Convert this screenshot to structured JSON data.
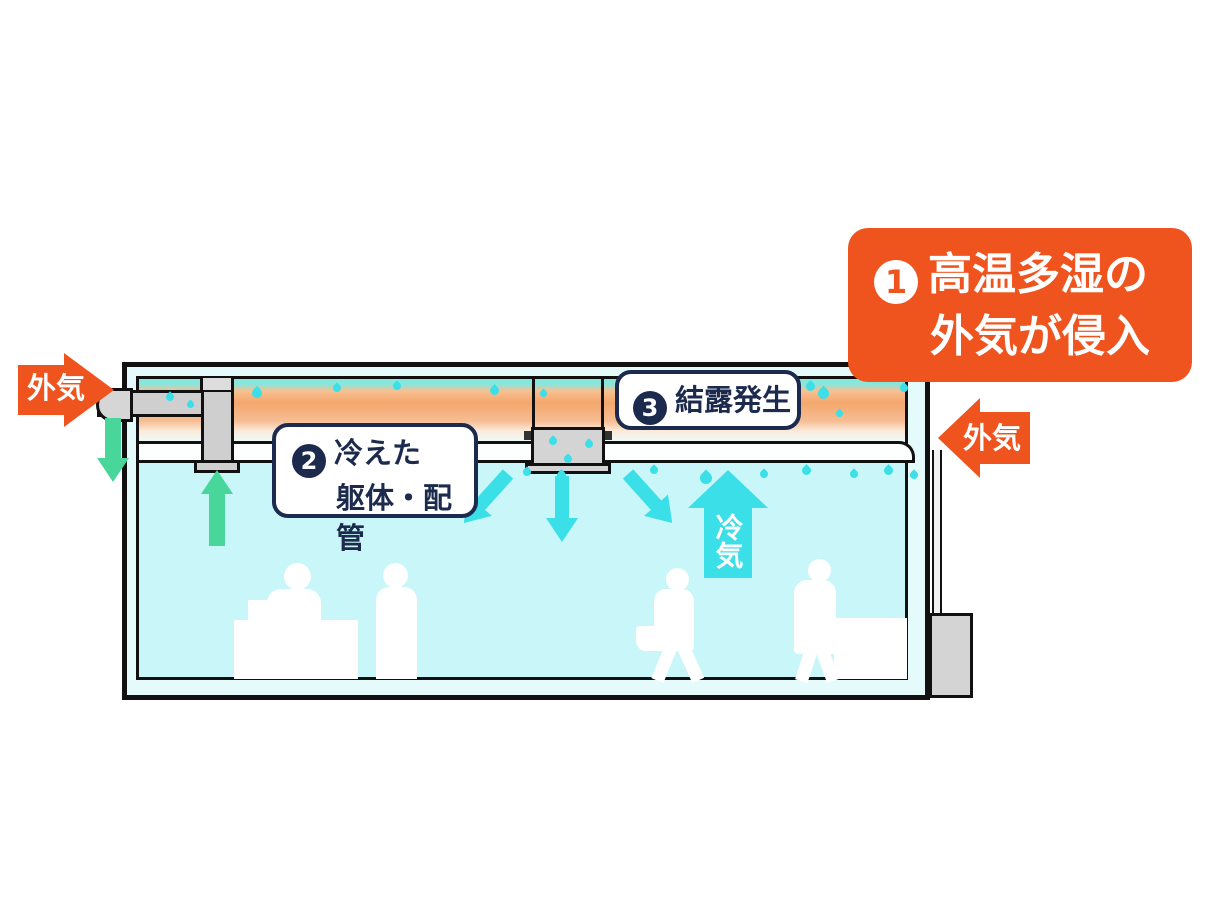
{
  "diagram": {
    "type": "building-cross-section-condensation-diagram",
    "palette": {
      "accent_orange": "#F0541E",
      "label_navy": "#1C2B4D",
      "cold_cyan": "#3ADFE8",
      "exhaust_green": "#49D69B",
      "room_fill": "#C9F6F9",
      "warm_air_glow": "#F3A76C"
    },
    "callout_1": {
      "number": "1",
      "line1": "高温多湿の",
      "line2": "外気が侵入"
    },
    "label_2": {
      "number": "2",
      "line1": "冷えた",
      "line2": "躯体・配管"
    },
    "label_3": {
      "number": "3",
      "text": "結露発生"
    },
    "outside_air_left_label": "外気",
    "outside_air_right_label": "外気",
    "cold_air_label": "冷気"
  }
}
